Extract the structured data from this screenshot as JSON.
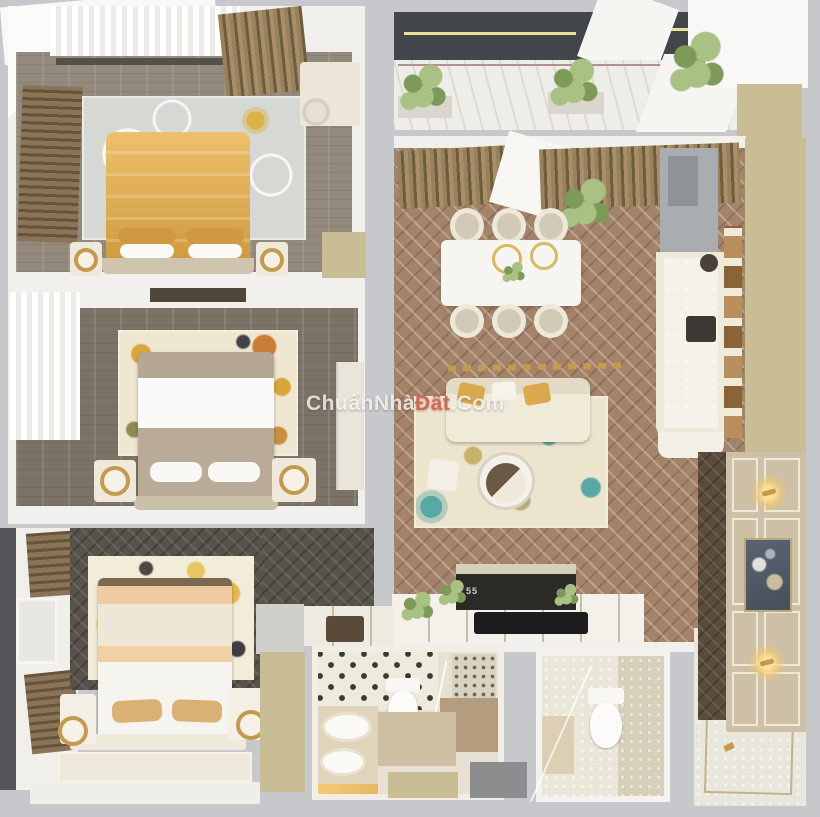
{
  "watermark": {
    "part1": "Chuẩn",
    "part2": "Nhà",
    "part3": "Đất",
    "part4": ".Com"
  },
  "tv": {
    "label": "55"
  },
  "colors": {
    "bg": "#c6c8cb",
    "wall": "#f2f0ec",
    "wallBright": "#f9f8f6",
    "tan": "#c9bd95",
    "gold": "#c49a4e",
    "bedGold1": "#eec06c",
    "bedGold2": "#cf9a3f",
    "floorLiving": "#a3836a",
    "floorB1": "#93897c",
    "floorB2": "#7b7466",
    "floorDark": "#57524a",
    "curtainA": "#97825e",
    "curtainB": "#6f5b3e",
    "deck": "#42454a",
    "deckLine": "#e9e19b",
    "plantA": "#a9c183",
    "plantB": "#7d9b58",
    "rugB1": "#d6d9d3",
    "rugB2": "#efe7d0",
    "rugCream": "#ece4cd",
    "teal": "#58a8a4",
    "panel": "#cdc0a7",
    "panelTrim": "#efe9da",
    "marble": "#efede7",
    "checkerBase": "#eeeade",
    "checkerDot": "#3c3a33",
    "grayMat": "#8b8d8f",
    "fridge": "#a9adb0",
    "tvBlack": "#2c2a26",
    "wmWhite": "rgba(255,255,255,0.78)",
    "wmRed": "rgba(213,92,72,0.85)"
  }
}
